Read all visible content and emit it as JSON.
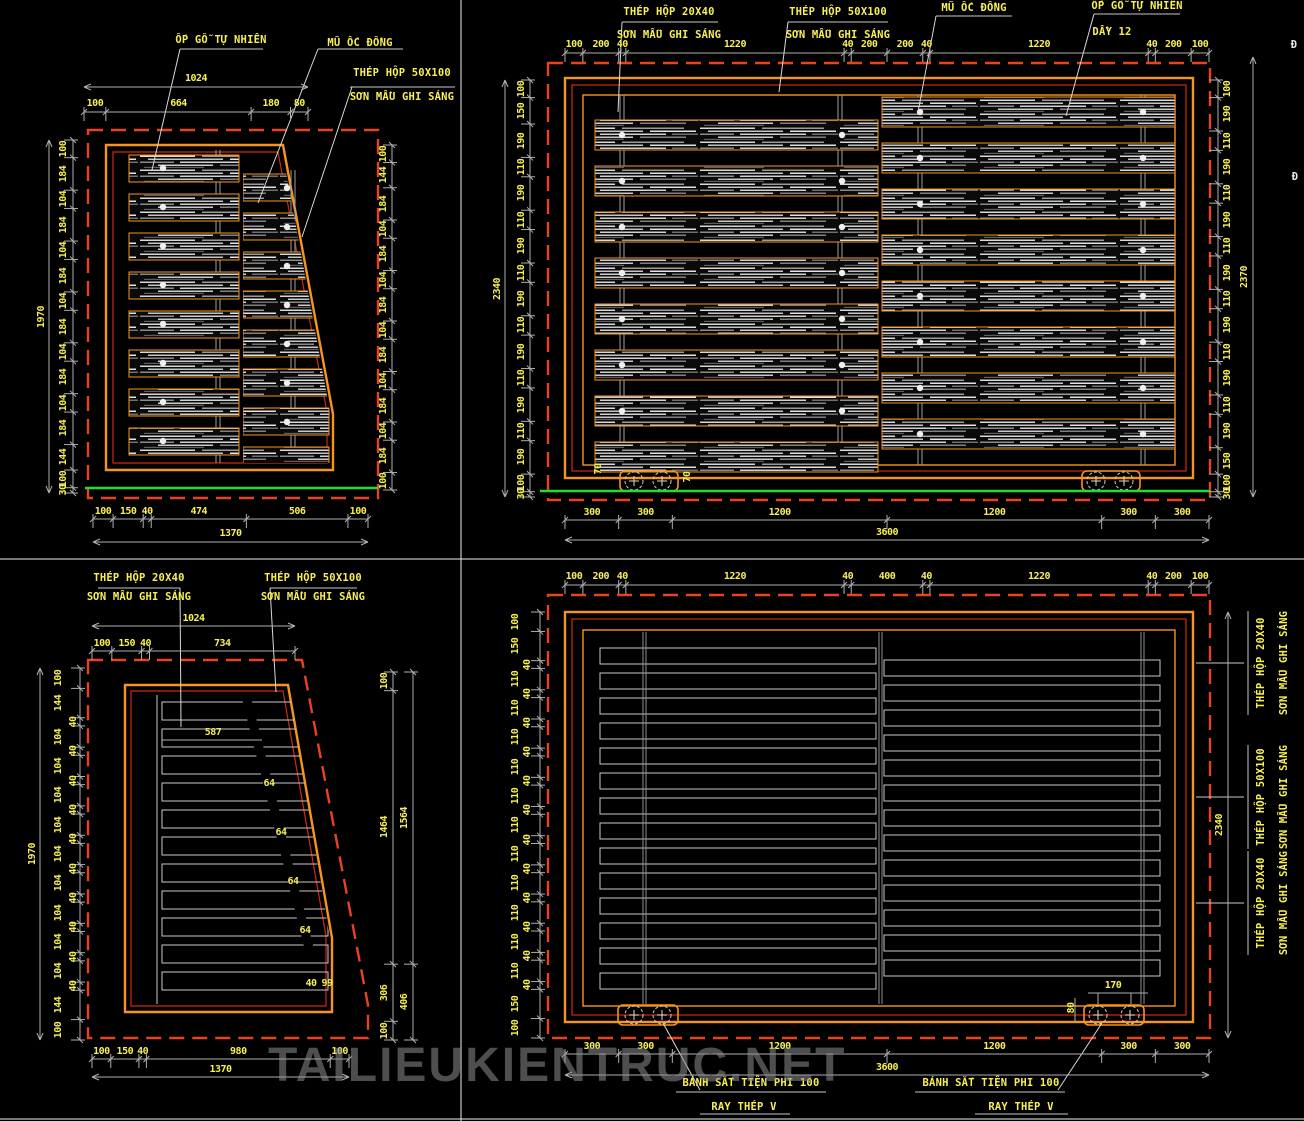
{
  "watermark": "TAILIEUKIENTRUC.NET",
  "colors": {
    "background": "#000000",
    "frame_orange": "#f7941d",
    "frame_red": "#cf2a0e",
    "dashed_opening": "#e8431c",
    "dimension_text": "#f7ef54",
    "dimension_line": "#b0b0b0",
    "leader_line": "#d8d8d8",
    "ground_line": "#1ddd38",
    "wood_light": "#d8d8d8"
  },
  "views": {
    "A": {
      "name": "gate-leaf-elevation-wood",
      "callouts": [
        {
          "t": "ỐP GỖ TỰ NHIÊN",
          "x": 221,
          "y": 40
        },
        {
          "t": "MŨ ỐC ĐỒNG",
          "x": 360,
          "y": 43
        },
        {
          "t": "THÉP HỘP 50X100",
          "x": 402,
          "y": 73
        },
        {
          "t": "SƠN MẦU GHI SÁNG",
          "x": 402,
          "y": 97
        }
      ],
      "chains": [
        {
          "values": [
            "100",
            "664",
            "180",
            "80"
          ],
          "o": "h",
          "line": 112,
          "from": 84,
          "to": 308,
          "loff": -8
        },
        {
          "values": [
            "100",
            "184",
            "104",
            "184",
            "104",
            "184",
            "104",
            "184",
            "104",
            "184",
            "104",
            "184",
            "144",
            "100",
            "30"
          ],
          "o": "v",
          "line": 73,
          "from": 140,
          "to": 493,
          "loff": -9
        },
        {
          "values": [
            "100",
            "144",
            "184",
            "104",
            "184",
            "104",
            "184",
            "104",
            "184",
            "104",
            "184",
            "104",
            "184",
            "100"
          ],
          "o": "v",
          "line": 392,
          "from": 145,
          "to": 490,
          "loff": -8
        },
        {
          "values": [
            "100",
            "150",
            "40",
            "474",
            "506",
            "100"
          ],
          "o": "h",
          "line": 519,
          "from": 93,
          "to": 368,
          "loff": -7
        }
      ],
      "overall": [
        {
          "t": "1024",
          "o": "h",
          "line": 87,
          "from": 84,
          "to": 308,
          "loff": -8
        },
        {
          "t": "1970",
          "o": "v",
          "line": 49,
          "from": 140,
          "to": 493,
          "loff": -7
        },
        {
          "t": "1370",
          "o": "h",
          "line": 542,
          "from": 93,
          "to": 368,
          "loff": -8
        }
      ],
      "freedims": []
    },
    "B": {
      "name": "double-gate-elevation-wood",
      "callouts": [
        {
          "t": "THÉP HỘP 20X40",
          "x": 669,
          "y": 12
        },
        {
          "t": "SƠN MẪU GHI SÁNG",
          "x": 669,
          "y": 35
        },
        {
          "t": "THÉP HỘP 50X100",
          "x": 838,
          "y": 12
        },
        {
          "t": "SƠN MẪU GHI SÁNG",
          "x": 838,
          "y": 35
        },
        {
          "t": "MŨ ỐC ĐỒNG",
          "x": 974,
          "y": 8
        },
        {
          "t": "ỐP GỖ TỰ NHIÊN",
          "x": 1137,
          "y": 6
        },
        {
          "t": "DẦY 12",
          "x": 1112,
          "y": 32
        },
        {
          "t": "Đ",
          "x": 1294,
          "y": 45,
          "white": 1
        },
        {
          "t": "Đ",
          "x": 1295,
          "y": 177,
          "white": 1
        }
      ],
      "chains": [
        {
          "values": [
            "100",
            "200",
            "40",
            "1220",
            "40",
            "200",
            "200",
            "40",
            "1220",
            "40",
            "200",
            "100"
          ],
          "o": "h",
          "line": 53,
          "from": 565,
          "to": 1209,
          "loff": -8
        },
        {
          "values": [
            "100",
            "150",
            "190",
            "110",
            "190",
            "110",
            "190",
            "110",
            "190",
            "110",
            "190",
            "110",
            "190",
            "110",
            "190",
            "100",
            "30"
          ],
          "o": "v",
          "line": 530,
          "from": 80,
          "to": 497,
          "loff": -8
        },
        {
          "values": [
            "100",
            "190",
            "110",
            "190",
            "110",
            "190",
            "110",
            "190",
            "110",
            "190",
            "110",
            "190",
            "110",
            "190",
            "150",
            "100",
            "30"
          ],
          "o": "v",
          "line": 1218,
          "from": 80,
          "to": 497,
          "loff": 10
        },
        {
          "values": [
            "300",
            "300",
            "1200",
            "1200",
            "300",
            "300"
          ],
          "o": "h",
          "line": 520,
          "from": 565,
          "to": 1209,
          "loff": -7
        }
      ],
      "overall": [
        {
          "t": "2340",
          "o": "v",
          "line": 505,
          "from": 80,
          "to": 497,
          "loff": -7
        },
        {
          "t": "2370",
          "o": "v",
          "line": 1253,
          "from": 57,
          "to": 497,
          "loff": -8
        },
        {
          "t": "3600",
          "o": "h",
          "line": 540,
          "from": 565,
          "to": 1209,
          "loff": -7
        }
      ],
      "freedims": [
        {
          "t": "70",
          "x": 599,
          "y": 469,
          "rot": 1
        },
        {
          "t": "70",
          "x": 688,
          "y": 477,
          "rot": 1
        }
      ]
    },
    "C": {
      "name": "gate-leaf-frame-elevation",
      "callouts": [
        {
          "t": "THÉP HỘP 20X40",
          "x": 139,
          "y": 578
        },
        {
          "t": "SƠN MẦU GHI SÁNG",
          "x": 139,
          "y": 597
        },
        {
          "t": "THÉP HỘP 50X100",
          "x": 313,
          "y": 578
        },
        {
          "t": "SƠN MẦU GHI SÁNG",
          "x": 313,
          "y": 597
        }
      ],
      "chains": [
        {
          "values": [
            "100",
            "150",
            "40",
            "734"
          ],
          "o": "h",
          "line": 651,
          "from": 92,
          "to": 295,
          "loff": -7
        },
        {
          "values": [
            "100",
            "144",
            "40",
            "104",
            "40",
            "104",
            "40",
            "104",
            "40",
            "104",
            "40",
            "104",
            "40",
            "104",
            "40",
            "104",
            "40",
            "104",
            "40",
            "104",
            "40",
            "144",
            "100"
          ],
          "o": "v",
          "line": 80,
          "from": 668,
          "to": 1040,
          "loff": -21,
          "alt": {
            "40": -6,
            "def": -21
          }
        },
        {
          "values": [
            "100",
            "1464",
            "306",
            "100"
          ],
          "o": "v",
          "line": 393,
          "from": 672,
          "to": 1040,
          "loff": -8
        },
        {
          "values": [
            "1564",
            "406"
          ],
          "o": "v",
          "line": 413,
          "from": 672,
          "to": 1040,
          "loff": -8
        },
        {
          "values": [
            "100",
            "150",
            "40",
            "980",
            "100"
          ],
          "o": "h",
          "line": 1059,
          "from": 92,
          "to": 349,
          "loff": -7
        }
      ],
      "overall": [
        {
          "t": "1024",
          "o": "h",
          "line": 626,
          "from": 92,
          "to": 295,
          "loff": -7
        },
        {
          "t": "1970",
          "o": "v",
          "line": 40,
          "from": 668,
          "to": 1040,
          "loff": -7
        },
        {
          "t": "1370",
          "o": "h",
          "line": 1077,
          "from": 92,
          "to": 349,
          "loff": -7
        }
      ],
      "freedims": [
        {
          "t": "587",
          "x": 213,
          "y": 733
        },
        {
          "t": "64",
          "x": 269,
          "y": 784
        },
        {
          "t": "64",
          "x": 281,
          "y": 833
        },
        {
          "t": "64",
          "x": 293,
          "y": 882
        },
        {
          "t": "64",
          "x": 305,
          "y": 931
        },
        {
          "t": "40",
          "x": 311,
          "y": 984
        },
        {
          "t": "99",
          "x": 327,
          "y": 984
        }
      ]
    },
    "D": {
      "name": "double-gate-frame-elevation",
      "callouts": [
        {
          "t": "THÉP HỘP 20X40",
          "x": 1261,
          "y": 663,
          "rot": 1
        },
        {
          "t": "SƠN MẪU GHI SÁNG",
          "x": 1284,
          "y": 663,
          "rot": 1
        },
        {
          "t": "THÉP HỘP 50X100",
          "x": 1261,
          "y": 797,
          "rot": 1
        },
        {
          "t": "SƠN MẪU GHI SÁNG",
          "x": 1284,
          "y": 797,
          "rot": 1
        },
        {
          "t": "THÉP HỘP 20X40",
          "x": 1261,
          "y": 903,
          "rot": 1
        },
        {
          "t": "SƠN MẪU GHI SÁNG",
          "x": 1284,
          "y": 903,
          "rot": 1
        },
        {
          "t": "BÁNH SẮT TIỆN PHI 100",
          "x": 751,
          "y": 1083
        },
        {
          "t": "RAY THÉP V",
          "x": 744,
          "y": 1107
        },
        {
          "t": "BÁNH SẮT TIỆN PHI 100",
          "x": 991,
          "y": 1083
        },
        {
          "t": "RAY THÉP V",
          "x": 1021,
          "y": 1107
        }
      ],
      "chains": [
        {
          "values": [
            "100",
            "200",
            "40",
            "1220",
            "40",
            "400",
            "40",
            "1220",
            "40",
            "200",
            "100"
          ],
          "o": "h",
          "line": 585,
          "from": 565,
          "to": 1209,
          "loff": -8
        },
        {
          "values": [
            "100",
            "150",
            "40",
            "110",
            "40",
            "110",
            "40",
            "110",
            "40",
            "110",
            "40",
            "110",
            "40",
            "110",
            "40",
            "110",
            "40",
            "110",
            "40",
            "110",
            "40",
            "110",
            "40",
            "110",
            "40",
            "150",
            "100"
          ],
          "o": "v",
          "line": 540,
          "from": 612,
          "to": 1038,
          "loff": -24,
          "alt": {
            "40": -12,
            "def": -24
          }
        },
        {
          "values": [
            "300",
            "300",
            "1200",
            "1200",
            "300",
            "300"
          ],
          "o": "h",
          "line": 1054,
          "from": 565,
          "to": 1209,
          "loff": -7
        }
      ],
      "overall": [
        {
          "t": "2340",
          "o": "v",
          "line": 1228,
          "from": 612,
          "to": 1038,
          "loff": -8
        },
        {
          "t": "3600",
          "o": "h",
          "line": 1075,
          "from": 565,
          "to": 1209,
          "loff": -7
        }
      ],
      "freedims": [
        {
          "t": "170",
          "x": 1113,
          "y": 986
        },
        {
          "t": "80",
          "x": 1072,
          "y": 1008,
          "rot": 1
        }
      ]
    }
  }
}
